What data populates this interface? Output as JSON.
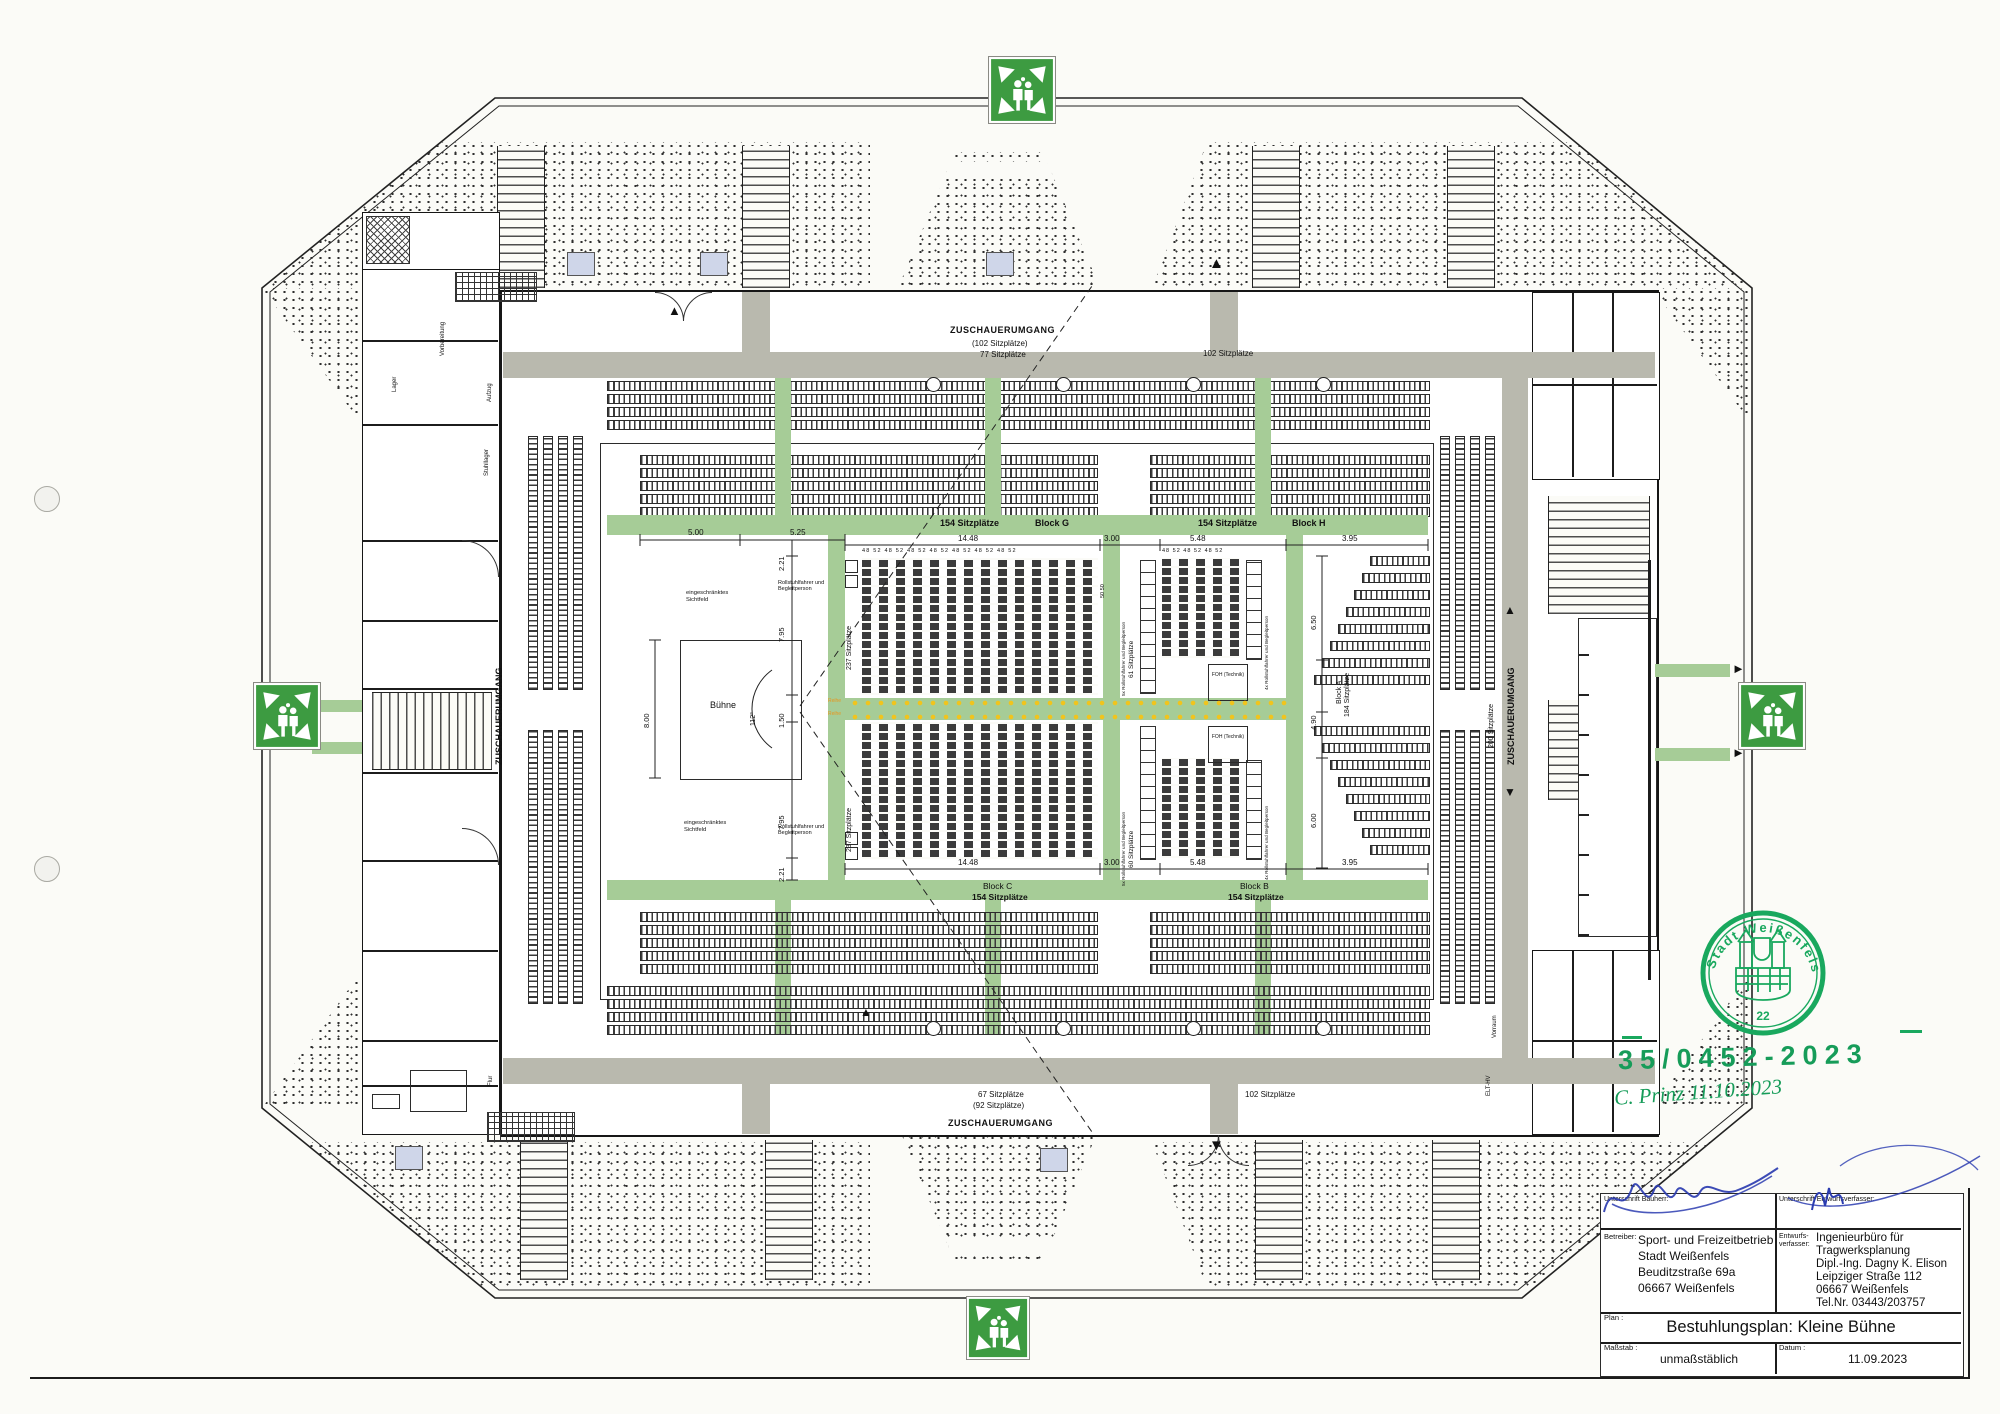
{
  "corridors": {
    "top": "ZUSCHAUERUMGANG",
    "bottom": "ZUSCHAUERUMGANG",
    "left": "ZUSCHAUERUMGANG",
    "right": "ZUSCHAUERUMGANG",
    "right_count": "200 Sitzplätze",
    "top_note1": "(102 Sitzplätze)",
    "top_note2": "77 Sitzplätze",
    "top_right_count": "102 Sitzplätze",
    "bottom_note1": "67 Sitzplätze",
    "bottom_note2": "(92 Sitzplätze)",
    "bottom_right_count": "102 Sitzplätze"
  },
  "blocks": {
    "g": "Block G",
    "h": "Block H",
    "c": "Block C",
    "b": "Block B",
    "a": "Block A",
    "count154": "154 Sitzplätze",
    "count184": "184 Sitzplätze",
    "count237": "237 Sitzplätze",
    "count61": "61 Sitzplätze",
    "count60": "60 Sitzplätze",
    "wheel5": "5x Rollstuhlfahrer und Begleitperson",
    "wheel4": "4x Rollstuhlfahrer und Begleitperson",
    "wheel": "Rollstuhlfahrer und Begleitperson",
    "foh": "FOH (Technik)",
    "reihe": "Reihe"
  },
  "stage": {
    "label": "Bühne",
    "angle": "112°",
    "sight": "eingeschränktes Sichtfeld"
  },
  "dims": {
    "d500": "5.00",
    "d525": "5.25",
    "d221": "2.21",
    "d795": "7.95",
    "d150": "1.50",
    "d795b": "7.95",
    "d221b": "2.21",
    "d1448": "14.48",
    "d300": "3.00",
    "d548": "5.48",
    "d395": "3.95",
    "d650": "6.50",
    "d490": "4.90",
    "d600": "6.00",
    "d800": "8.00",
    "fifty": "50 50",
    "seat_numbers": "48 52 48 52 48 52 48 52 48 52 48 52 48 52",
    "seat_numbers_small": "48 52 48 52 48 52"
  },
  "rooms": {
    "lager": "Lager",
    "vorbereitung": "Vorbereitung",
    "aufzug": "Aufzug",
    "stuhllager": "Stuhllager",
    "flur": "Flur",
    "vorraum": "Vorraum",
    "elt": "ELT-HV"
  },
  "stamp": {
    "city": "Stadt Weißenfels",
    "number": "22",
    "file_no": "35/0452-2023",
    "handwriting": "C. Prinz  11.10.2023"
  },
  "titleblock": {
    "sig_bauherr_label": "Unterschrift Bauherr:",
    "sig_entwurf_label": "Unterschrift Entwurfsverfasser:",
    "betreiber_label": "Betreiber:",
    "betreiber1": "Sport- und Freizeitbetrieb",
    "betreiber2": "Stadt Weißenfels",
    "betreiber3": "Beuditzstraße 69a",
    "betreiber4": "06667 Weißenfels",
    "entwurf_label1": "Entwurfs-",
    "entwurf_label2": "verfasser:",
    "entwurf1": "Ingenieurbüro für",
    "entwurf2": "Tragwerksplanung",
    "entwurf3": "Dipl.-Ing. Dagny K. Elison",
    "entwurf4": "Leipziger Straße 112",
    "entwurf5": "06667 Weißenfels",
    "entwurf6": "Tel.Nr. 03443/203757",
    "plan_label": "Plan :",
    "plan_title": "Bestuhlungsplan: Kleine Bühne",
    "massstab_label": "Maßstab :",
    "massstab_value": "unmaßstäblich",
    "datum_label": "Datum :",
    "datum_value": "11.09.2023"
  },
  "icons": {
    "arrow_up": "▲",
    "arrow_down": "▼",
    "arrow_right": "►"
  }
}
